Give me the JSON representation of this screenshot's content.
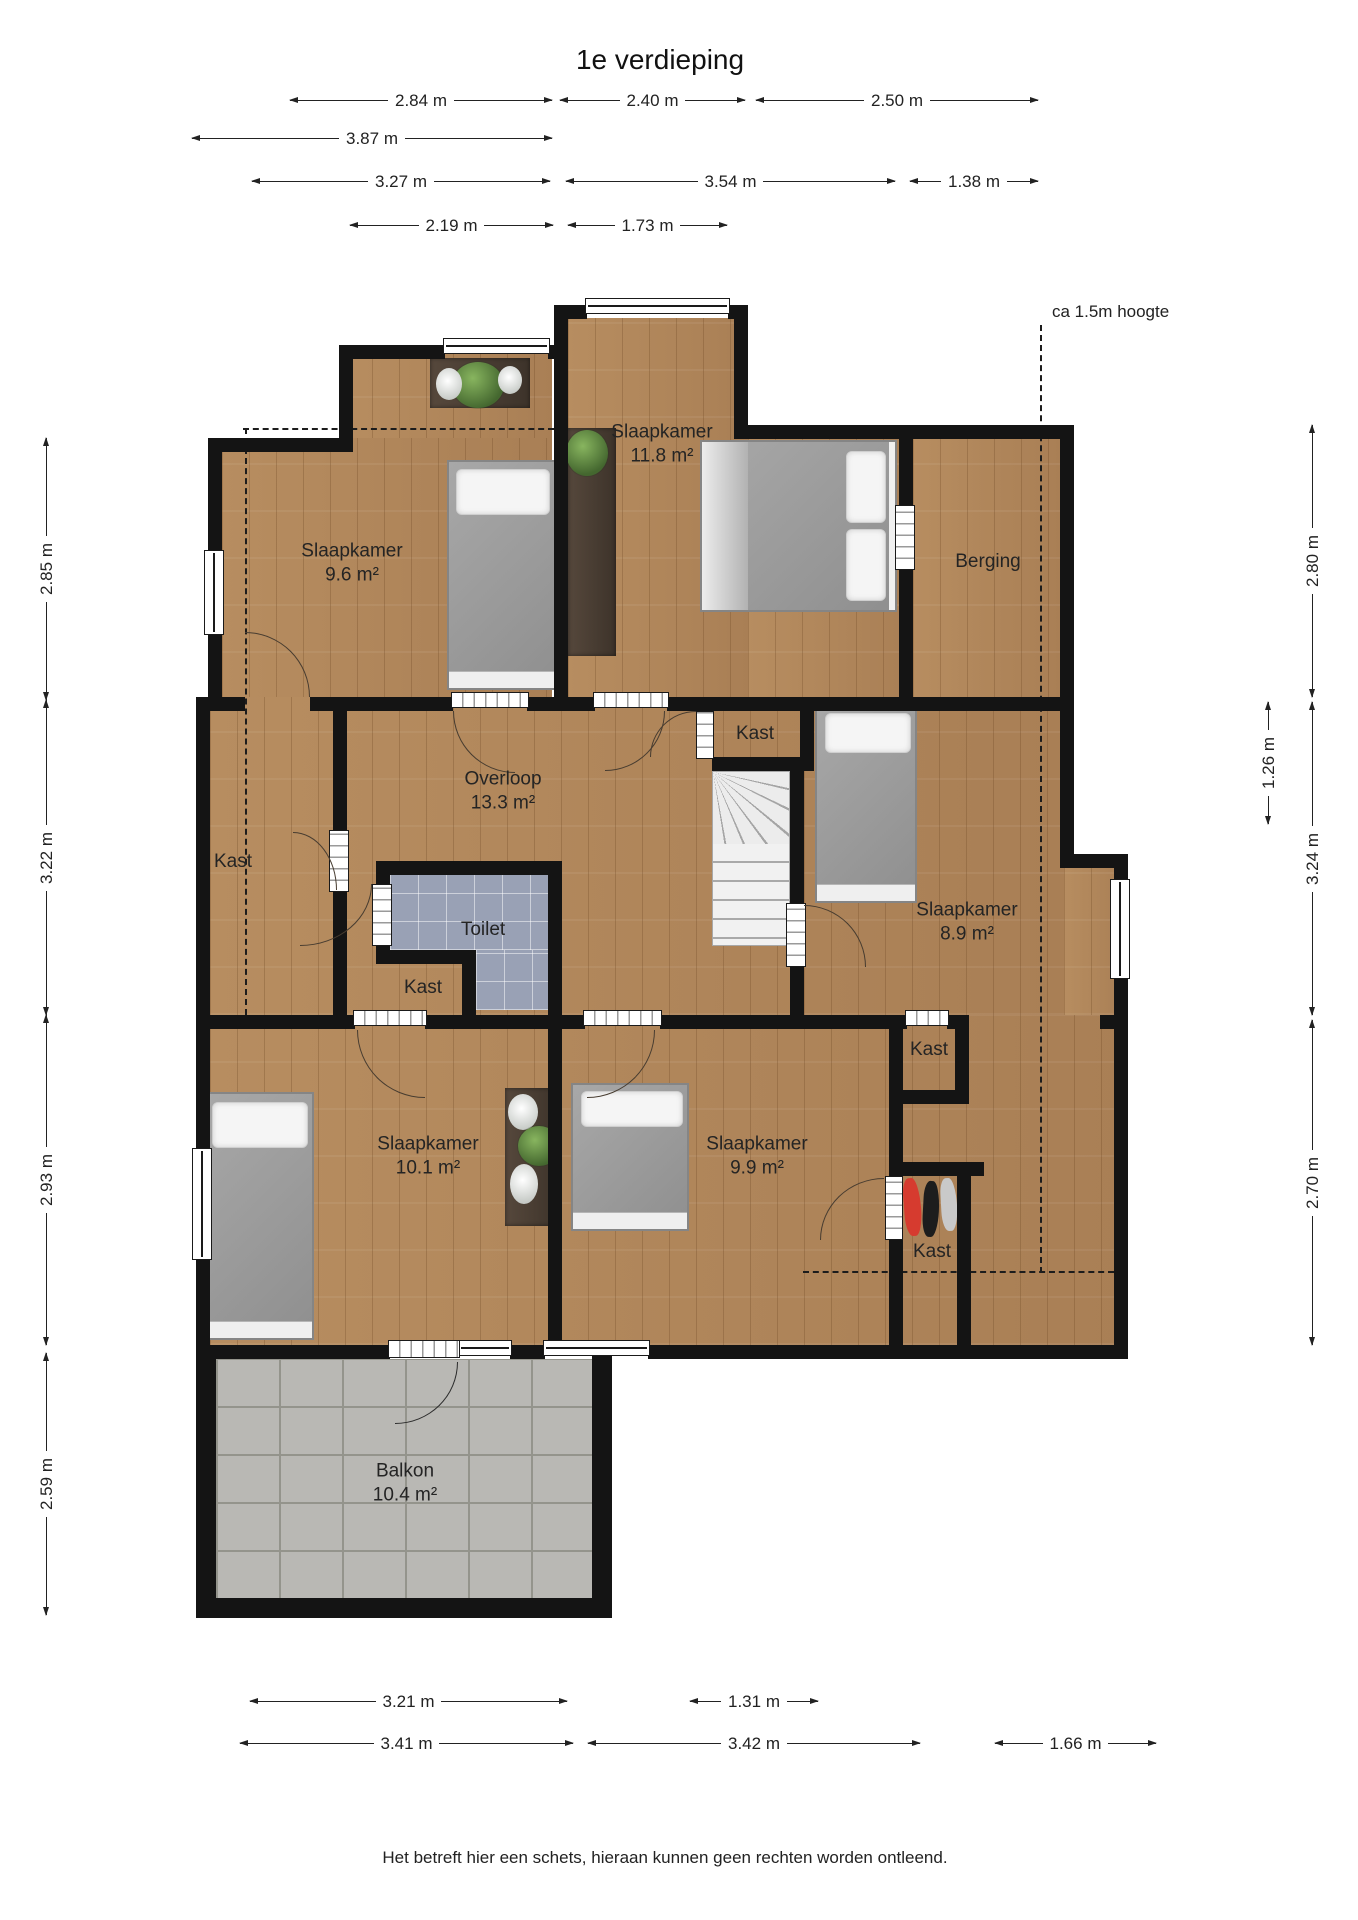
{
  "title": "1e verdieping",
  "annotation_height": "ca 1.5m hoogte",
  "disclaimer": "Het betreft hier een schets, hieraan kunnen geen rechten worden ontleend.",
  "rooms": {
    "slaapkamer_tl": {
      "name": "Slaapkamer",
      "area": "9.6 m²"
    },
    "slaapkamer_tm": {
      "name": "Slaapkamer",
      "area": "11.8 m²"
    },
    "berging": {
      "name": "Berging"
    },
    "kast_top": {
      "name": "Kast"
    },
    "overloop": {
      "name": "Overloop",
      "area": "13.3 m²"
    },
    "kast_left": {
      "name": "Kast"
    },
    "toilet": {
      "name": "Toilet"
    },
    "kast_toilet": {
      "name": "Kast"
    },
    "slaapkamer_mr": {
      "name": "Slaapkamer",
      "area": "8.9 m²"
    },
    "kast_right": {
      "name": "Kast"
    },
    "slaapkamer_bl": {
      "name": "Slaapkamer",
      "area": "10.1 m²"
    },
    "slaapkamer_bm": {
      "name": "Slaapkamer",
      "area": "9.9 m²"
    },
    "kast_bottom": {
      "name": "Kast"
    },
    "balkon": {
      "name": "Balkon",
      "area": "10.4 m²"
    }
  },
  "dimensions": {
    "top": [
      "2.84 m",
      "2.40 m",
      "2.50 m",
      "3.87 m",
      "3.27 m",
      "3.54 m",
      "1.38 m",
      "2.19 m",
      "1.73 m"
    ],
    "left": [
      "2.85 m",
      "3.22 m",
      "2.93 m",
      "2.59 m"
    ],
    "right": [
      "2.80 m",
      "3.24 m",
      "2.70 m",
      "1.26 m"
    ],
    "bottom": [
      "3.21 m",
      "1.31 m",
      "3.41 m",
      "3.42 m",
      "1.66 m"
    ]
  },
  "colors": {
    "wall": "#141414",
    "wood_floor": "#b3895d",
    "toilet_tile": "#99a1b5",
    "balcony_tile": "#b9b8b4",
    "bed_blanket": "#9e9e9e",
    "plant": "#4e7d3c",
    "clothes": [
      "#d63b2f",
      "#1d1d1d",
      "#c9c9c9"
    ]
  }
}
